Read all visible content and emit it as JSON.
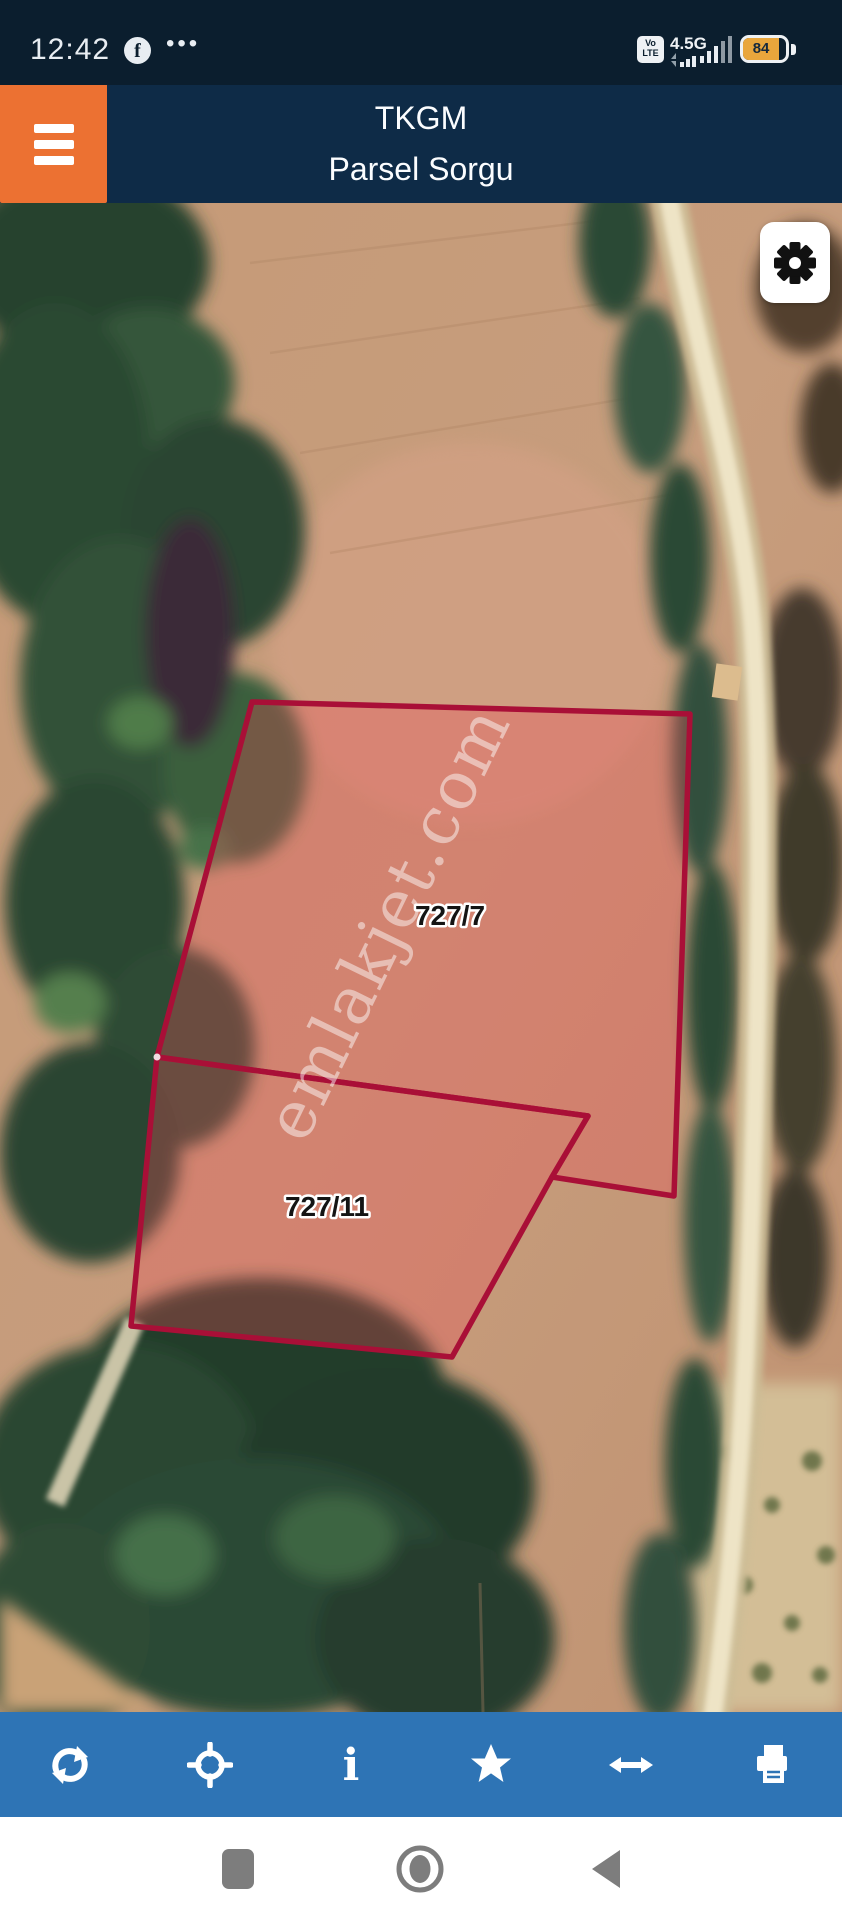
{
  "status_bar": {
    "time": "12:42",
    "facebook_initial": "f",
    "more_dots": "•••",
    "volte_top": "Vo",
    "volte_bottom": "LTE",
    "network_type": "4.5G",
    "battery_percent": "84"
  },
  "header": {
    "app_title": "TKGM",
    "screen_title": "Parsel Sorgu"
  },
  "map": {
    "watermark": "emlakjet.com",
    "parcels": [
      {
        "label": "727/7"
      },
      {
        "label": "727/11"
      }
    ]
  },
  "toolbar": {
    "icons": [
      "refresh-icon",
      "locate-icon",
      "info-icon",
      "star-icon",
      "resize-horizontal-icon",
      "print-icon"
    ]
  },
  "android_nav": {
    "icons": [
      "recents-icon",
      "home-icon",
      "back-icon"
    ]
  },
  "colors": {
    "status_navy": "#0b1e2e",
    "header_navy": "#0e2b47",
    "accent_orange": "#ec7132",
    "toolbar_blue": "#2e74b5",
    "parcel_stroke": "#a90f37",
    "battery_fill": "#e9a63c"
  }
}
